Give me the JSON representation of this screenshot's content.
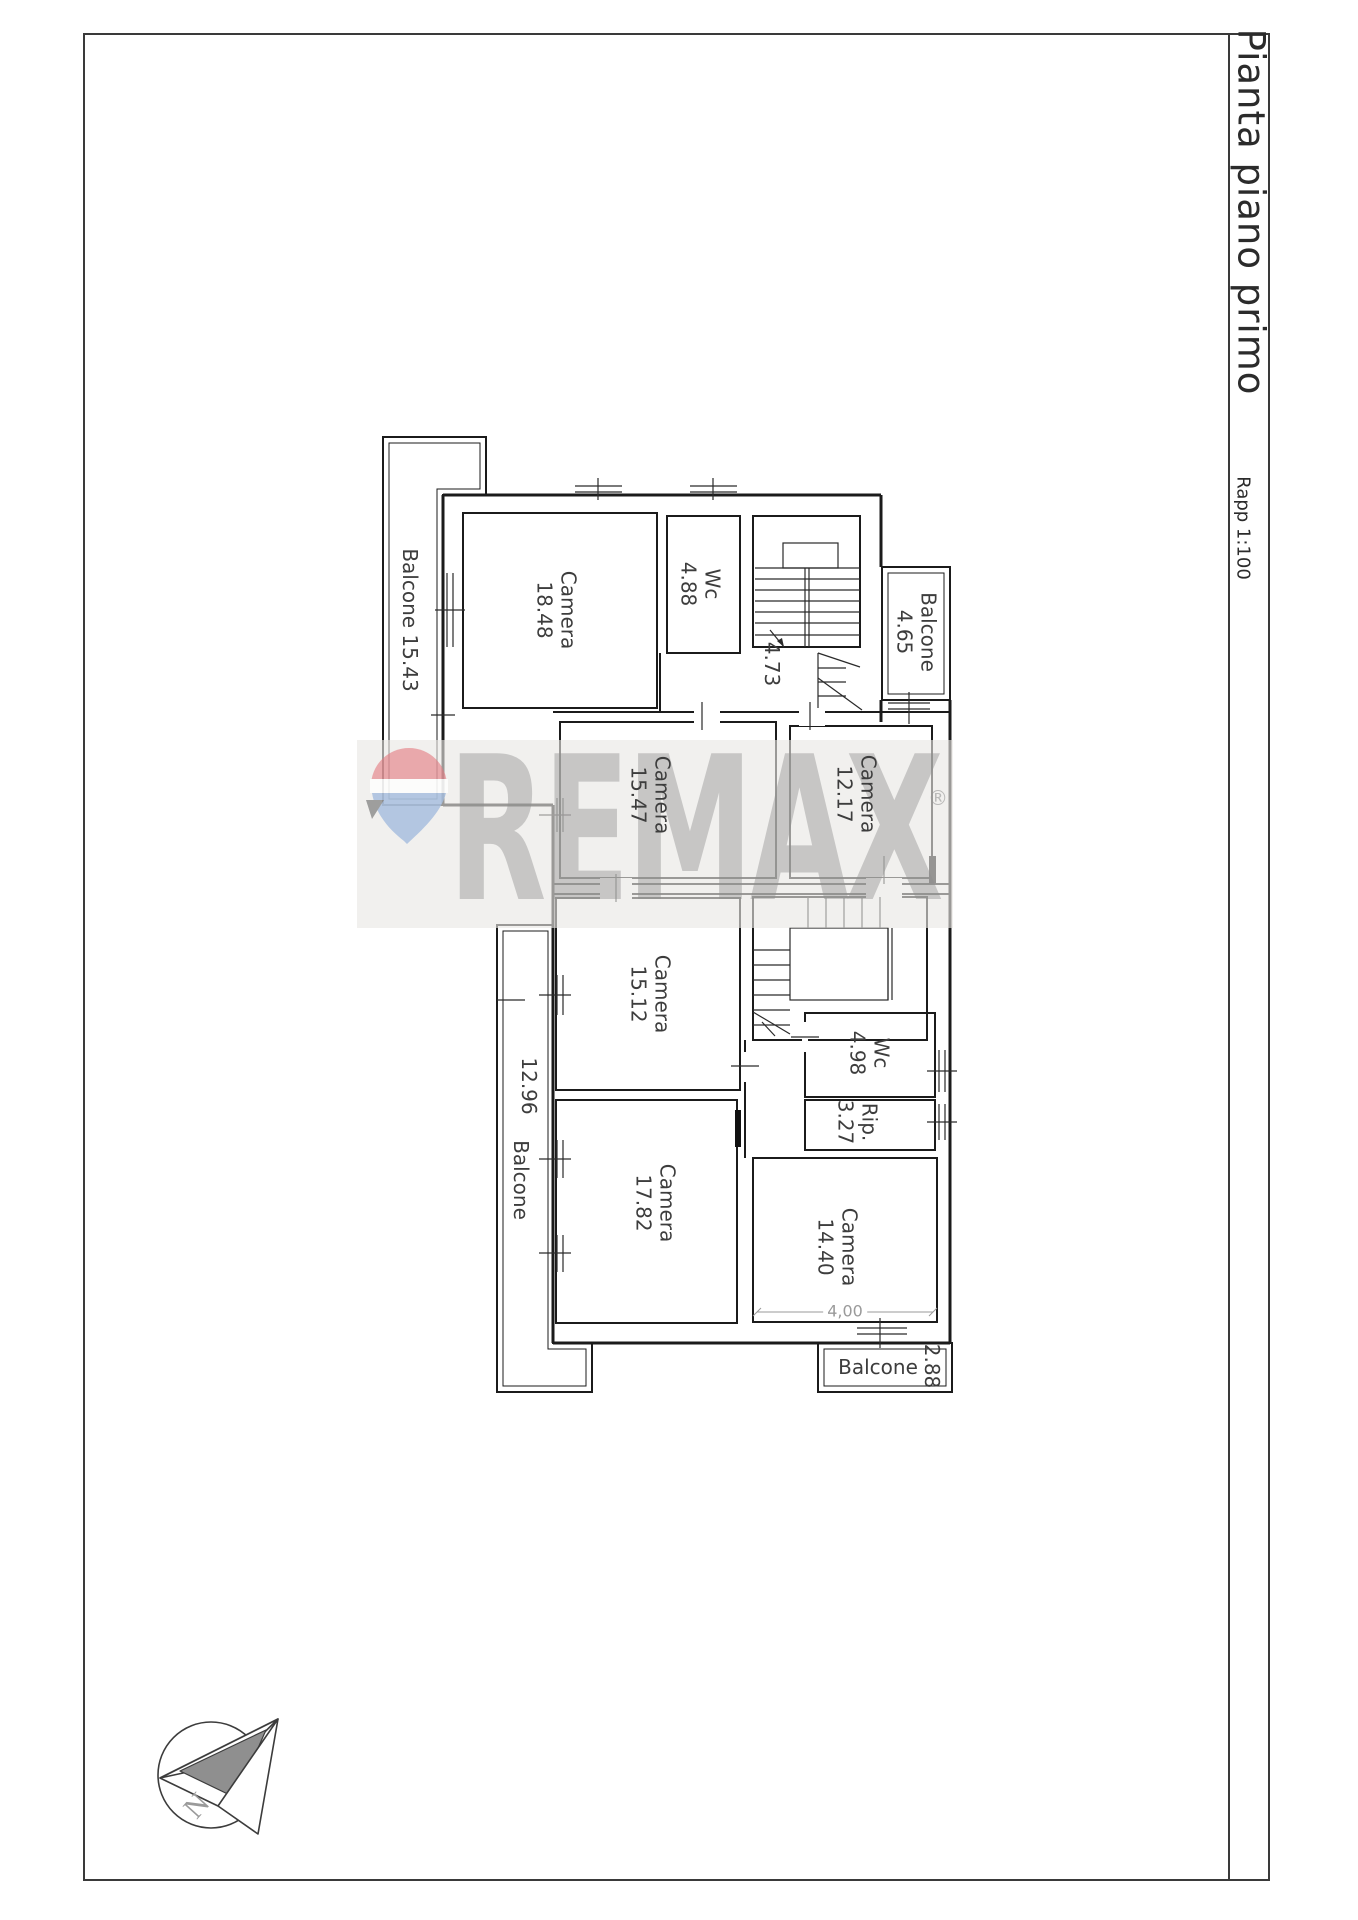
{
  "title_block": {
    "title": "Pianta piano primo",
    "scale": "Rapp 1:100"
  },
  "watermark": {
    "brand": "REMAX",
    "registered": "®",
    "balloon_red": "#e4787e",
    "balloon_blue": "#a4bcde"
  },
  "compass": {
    "north": "N"
  },
  "rooms": {
    "balcone_nw": {
      "name": "Balcone",
      "area": "15.43"
    },
    "camera_nw": {
      "name": "Camera",
      "area": "18.48"
    },
    "wc_top": {
      "name": "Wc",
      "area": "4.88"
    },
    "hall_top": {
      "area": "4.73"
    },
    "balcone_ne": {
      "name": "Balcone",
      "area": "4.65"
    },
    "camera_w": {
      "name": "Camera",
      "area": "15.47"
    },
    "camera_e": {
      "name": "Camera",
      "area": "12.17"
    },
    "camera_mw": {
      "name": "Camera",
      "area": "15.12"
    },
    "balcone_w": {
      "name": "Balcone",
      "area": "12.96"
    },
    "camera_sw": {
      "name": "Camera",
      "area": "17.82"
    },
    "wc_bottom": {
      "name": "Wc",
      "area": "4.98"
    },
    "rip": {
      "name": "Rip.",
      "area": "3.27"
    },
    "camera_se": {
      "name": "Camera",
      "area": "14.40"
    },
    "balcone_s": {
      "name": "Balcone",
      "area": "2.88"
    }
  },
  "dimensions": {
    "camera_se_width": "4,00"
  }
}
